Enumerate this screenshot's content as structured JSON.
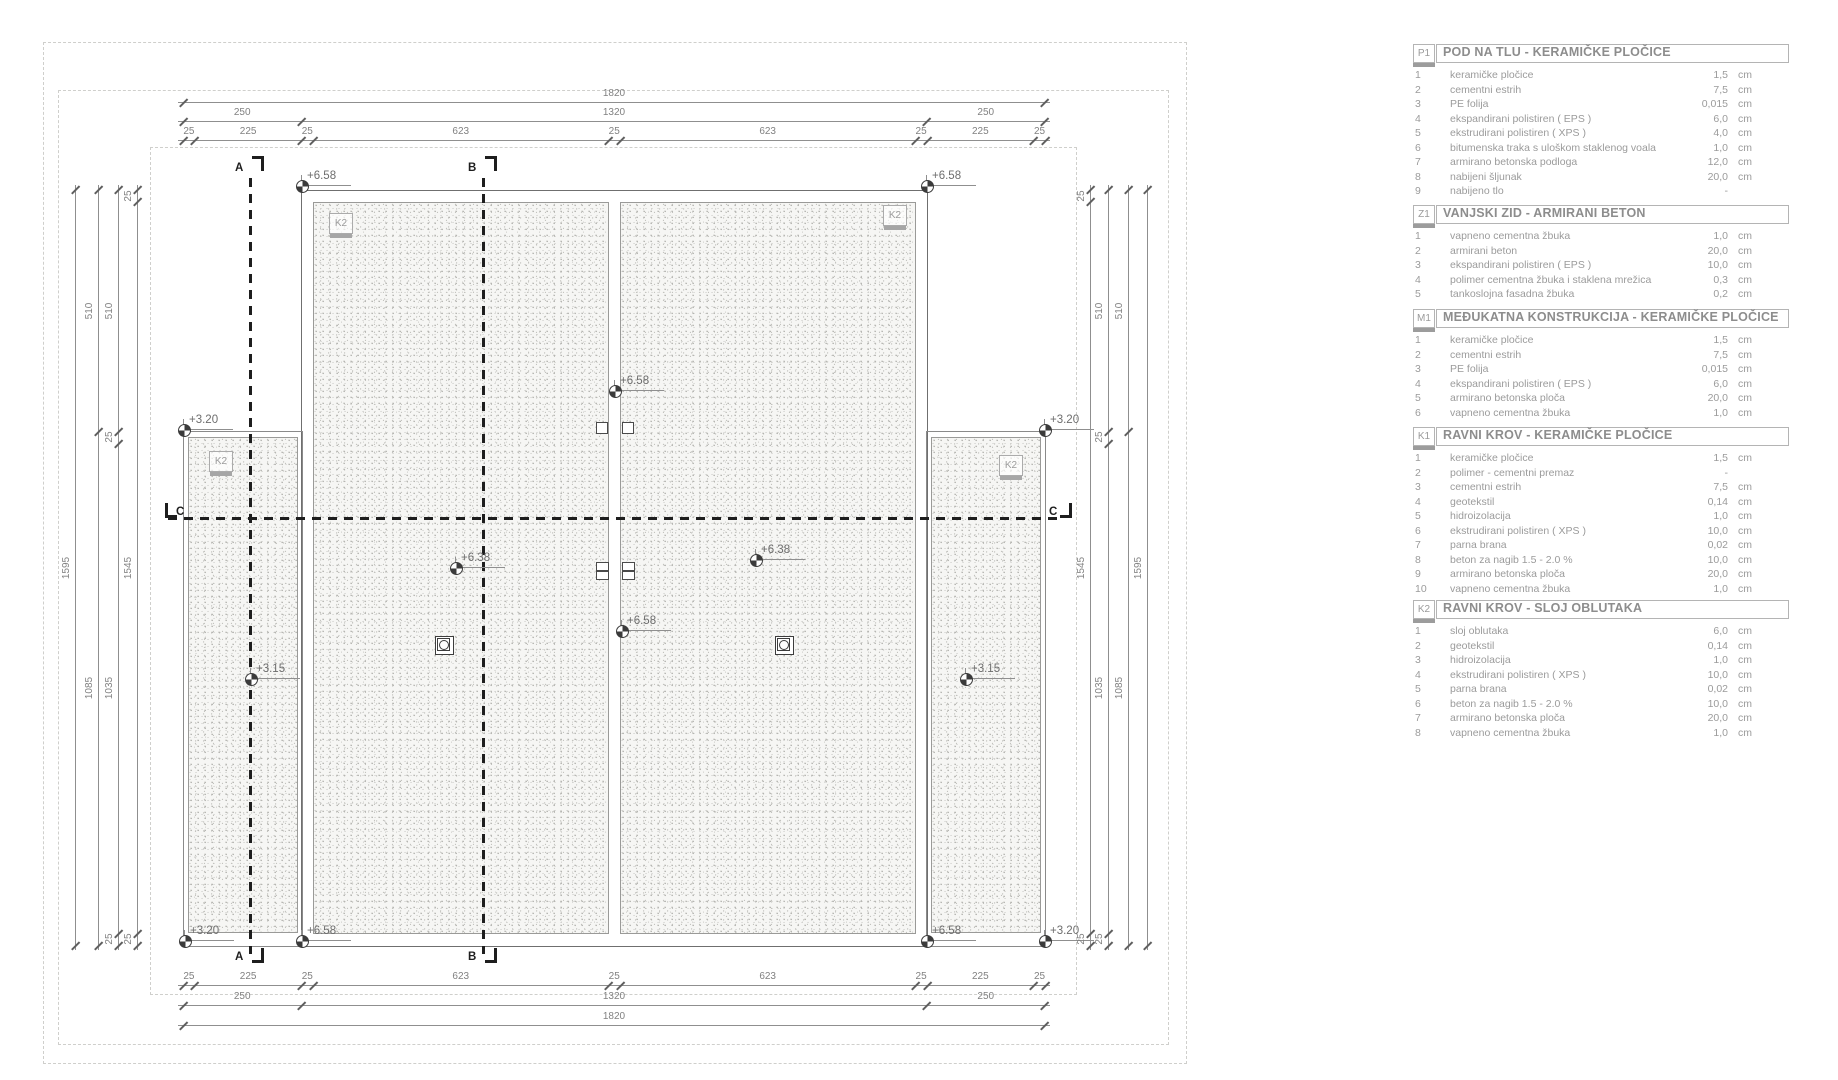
{
  "plan": {
    "section_markers": [
      {
        "id": "A"
      },
      {
        "id": "B"
      },
      {
        "id": "C"
      }
    ],
    "roof_area_tags": [
      {
        "place": "left-wing",
        "label": "K2"
      },
      {
        "place": "main-left",
        "label": "K2"
      },
      {
        "place": "main-right",
        "label": "K2"
      },
      {
        "place": "right-wing",
        "label": "K2"
      }
    ],
    "elevation_markers": [
      {
        "place": "main-top-left",
        "label": "+6.58"
      },
      {
        "place": "main-top-right",
        "label": "+6.58"
      },
      {
        "place": "left-wing-top",
        "label": "+3.20"
      },
      {
        "place": "right-wing-top",
        "label": "+3.20"
      },
      {
        "place": "mid-wall-upper",
        "label": "+6.58"
      },
      {
        "place": "main-left-field",
        "label": "+6.38"
      },
      {
        "place": "main-right-field",
        "label": "+6.38"
      },
      {
        "place": "mid-wall-lower",
        "label": "+6.58"
      },
      {
        "place": "left-wing-field",
        "label": "+3.15"
      },
      {
        "place": "right-wing-field",
        "label": "+3.15"
      },
      {
        "place": "bottom-left-wing",
        "label": "+3.20"
      },
      {
        "place": "main-bottom-left",
        "label": "+6.58"
      },
      {
        "place": "main-bottom-right",
        "label": "+6.58"
      },
      {
        "place": "bottom-right-wing",
        "label": "+3.20"
      }
    ],
    "dimensions": {
      "top": [
        {
          "segments": [
            "1820"
          ]
        },
        {
          "segments": [
            "250",
            "1320",
            "250"
          ]
        },
        {
          "segments": [
            "25",
            "225",
            "25",
            "623",
            "25",
            "623",
            "25",
            "225",
            "25"
          ]
        }
      ],
      "bottom": [
        {
          "segments": [
            "25",
            "225",
            "25",
            "623",
            "25",
            "623",
            "25",
            "225",
            "25"
          ]
        },
        {
          "segments": [
            "250",
            "1320",
            "250"
          ]
        },
        {
          "segments": [
            "1820"
          ]
        }
      ],
      "left": [
        {
          "segments": [
            "1595"
          ]
        },
        {
          "segments": [
            "510",
            "1085"
          ]
        },
        {
          "segments": [
            "510",
            "25",
            "1035",
            "25"
          ]
        },
        {
          "segments": [
            "25",
            "1545",
            "25"
          ]
        }
      ],
      "right": [
        {
          "segments": [
            "25",
            "1545",
            "25"
          ]
        },
        {
          "segments": [
            "510",
            "25",
            "1035",
            "25"
          ]
        },
        {
          "segments": [
            "510",
            "1085"
          ]
        },
        {
          "segments": [
            "1595"
          ]
        }
      ]
    }
  },
  "legend": {
    "unit_default": "cm",
    "tables": [
      {
        "code": "P1",
        "title": "POD NA TLU - KERAMIČKE PLOČICE",
        "rows": [
          {
            "n": "1",
            "name": "keramičke pločice",
            "value": "1,5",
            "unit": "cm"
          },
          {
            "n": "2",
            "name": "cementni estrih",
            "value": "7,5",
            "unit": "cm"
          },
          {
            "n": "3",
            "name": "PE folija",
            "value": "0,015",
            "unit": "cm"
          },
          {
            "n": "4",
            "name": "ekspandirani polistiren ( EPS )",
            "value": "6,0",
            "unit": "cm"
          },
          {
            "n": "5",
            "name": "ekstrudirani polistiren ( XPS )",
            "value": "4,0",
            "unit": "cm"
          },
          {
            "n": "6",
            "name": "bitumenska traka s uloškom staklenog voala",
            "value": "1,0",
            "unit": "cm"
          },
          {
            "n": "7",
            "name": "armirano betonska podloga",
            "value": "12,0",
            "unit": "cm"
          },
          {
            "n": "8",
            "name": "nabijeni šljunak",
            "value": "20,0",
            "unit": "cm"
          },
          {
            "n": "9",
            "name": "nabijeno tlo",
            "value": "-",
            "unit": ""
          }
        ]
      },
      {
        "code": "Z1",
        "title": "VANJSKI ZID - ARMIRANI BETON",
        "rows": [
          {
            "n": "1",
            "name": "vapneno cementna žbuka",
            "value": "1,0",
            "unit": "cm"
          },
          {
            "n": "2",
            "name": "armirani beton",
            "value": "20,0",
            "unit": "cm"
          },
          {
            "n": "3",
            "name": "ekspandirani polistiren ( EPS )",
            "value": "10,0",
            "unit": "cm"
          },
          {
            "n": "4",
            "name": "polimer cementna žbuka i staklena mrežica",
            "value": "0,3",
            "unit": "cm"
          },
          {
            "n": "5",
            "name": "tankoslojna fasadna žbuka",
            "value": "0,2",
            "unit": "cm"
          }
        ]
      },
      {
        "code": "M1",
        "title": "MEĐUKATNA KONSTRUKCIJA - KERAMIČKE PLOČICE",
        "rows": [
          {
            "n": "1",
            "name": "keramičke pločice",
            "value": "1,5",
            "unit": "cm"
          },
          {
            "n": "2",
            "name": "cementni estrih",
            "value": "7,5",
            "unit": "cm"
          },
          {
            "n": "3",
            "name": "PE folija",
            "value": "0,015",
            "unit": "cm"
          },
          {
            "n": "4",
            "name": "ekspandirani polistiren ( EPS )",
            "value": "6,0",
            "unit": "cm"
          },
          {
            "n": "5",
            "name": "armirano betonska ploča",
            "value": "20,0",
            "unit": "cm"
          },
          {
            "n": "6",
            "name": "vapneno cementna žbuka",
            "value": "1,0",
            "unit": "cm"
          }
        ]
      },
      {
        "code": "K1",
        "title": "RAVNI KROV - KERAMIČKE PLOČICE",
        "rows": [
          {
            "n": "1",
            "name": "keramičke pločice",
            "value": "1,5",
            "unit": "cm"
          },
          {
            "n": "2",
            "name": "polimer - cementni premaz",
            "value": "-",
            "unit": ""
          },
          {
            "n": "3",
            "name": "cementni estrih",
            "value": "7,5",
            "unit": "cm"
          },
          {
            "n": "4",
            "name": "geotekstil",
            "value": "0,14",
            "unit": "cm"
          },
          {
            "n": "5",
            "name": "hidroizolacija",
            "value": "1,0",
            "unit": "cm"
          },
          {
            "n": "6",
            "name": "ekstrudirani polistiren ( XPS )",
            "value": "10,0",
            "unit": "cm"
          },
          {
            "n": "7",
            "name": "parna brana",
            "value": "0,02",
            "unit": "cm"
          },
          {
            "n": "8",
            "name": "beton za nagib 1.5  - 2.0 %",
            "value": "10,0",
            "unit": "cm"
          },
          {
            "n": "9",
            "name": "armirano betonska ploča",
            "value": "20,0",
            "unit": "cm"
          },
          {
            "n": "10",
            "name": "vapneno cementna žbuka",
            "value": "1,0",
            "unit": "cm"
          }
        ]
      },
      {
        "code": "K2",
        "title": "RAVNI KROV - SLOJ OBLUTAKA",
        "rows": [
          {
            "n": "1",
            "name": "sloj oblutaka",
            "value": "6,0",
            "unit": "cm"
          },
          {
            "n": "2",
            "name": "geotekstil",
            "value": "0,14",
            "unit": "cm"
          },
          {
            "n": "3",
            "name": "hidroizolacija",
            "value": "1,0",
            "unit": "cm"
          },
          {
            "n": "4",
            "name": "ekstrudirani polistiren ( XPS )",
            "value": "10,0",
            "unit": "cm"
          },
          {
            "n": "5",
            "name": "parna brana",
            "value": "0,02",
            "unit": "cm"
          },
          {
            "n": "6",
            "name": "beton za nagib 1.5  - 2.0 %",
            "value": "10,0",
            "unit": "cm"
          },
          {
            "n": "7",
            "name": "armirano betonska ploča",
            "value": "20,0",
            "unit": "cm"
          },
          {
            "n": "8",
            "name": "vapneno cementna žbuka",
            "value": "1,0",
            "unit": "cm"
          }
        ]
      }
    ]
  }
}
